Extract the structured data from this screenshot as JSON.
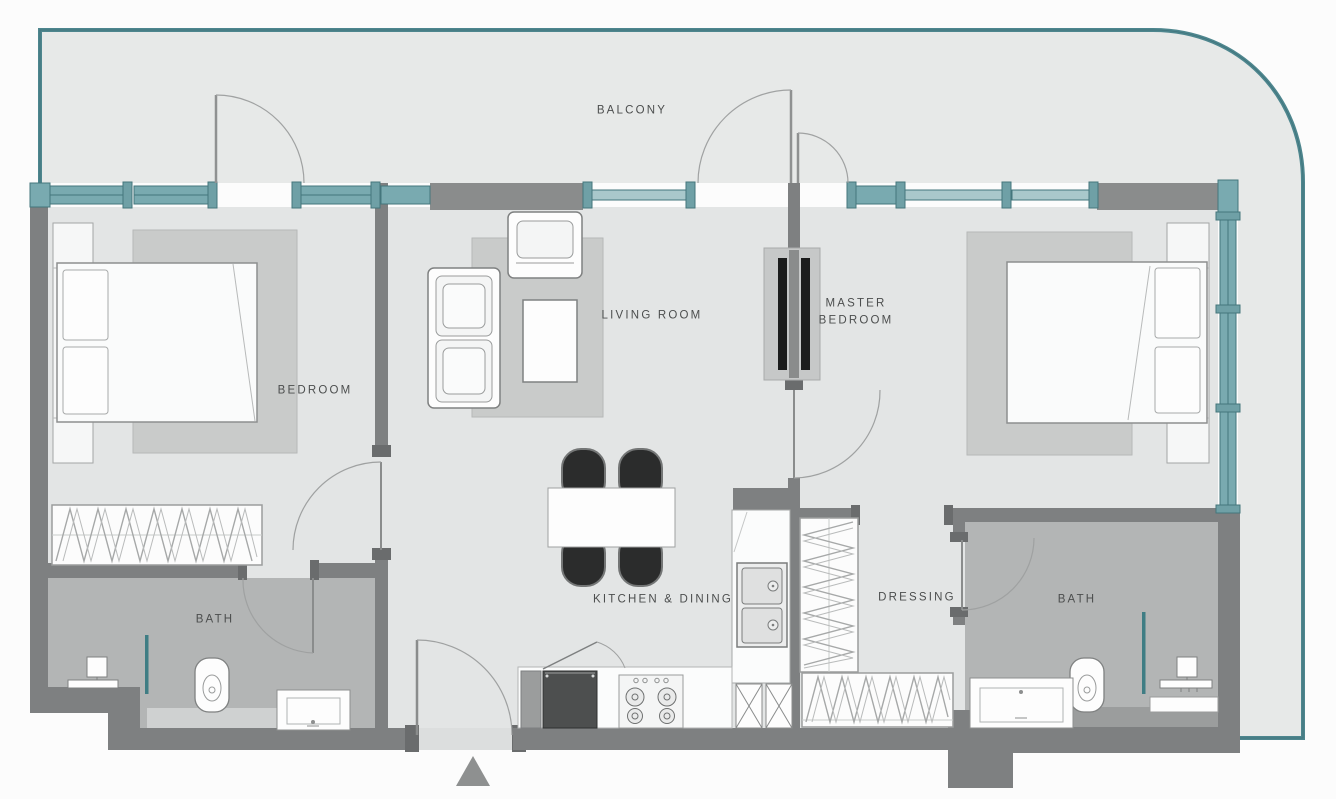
{
  "plan": {
    "type": "apartment-floor-plan",
    "rooms": [
      {
        "id": "balcony",
        "label": "BALCONY"
      },
      {
        "id": "bedroom",
        "label": "BEDROOM"
      },
      {
        "id": "living-room",
        "label": "LIVING ROOM"
      },
      {
        "id": "master-bedroom",
        "label": "MASTER BEDROOM"
      },
      {
        "id": "bath-1",
        "label": "BATH"
      },
      {
        "id": "kitchen-dining",
        "label": "KITCHEN & DINING"
      },
      {
        "id": "dressing",
        "label": "DRESSING"
      },
      {
        "id": "bath-2",
        "label": "BATH"
      }
    ],
    "icons": [
      {
        "name": "entrance-arrow",
        "shape": "triangle-up"
      }
    ],
    "colors": {
      "glazing_teal": "#79aab0",
      "glazing_edge": "#44767c",
      "outer_rail_teal": "#4e868e",
      "wall_grey": "#7e8081",
      "wall_dark": "#6a6c6d",
      "wall_block": "#8a8c8c",
      "floor_light": "#e3e5e5",
      "balcony_floor": "#e7e9e8",
      "bath_floor": "#b3b5b5",
      "rug_grey": "#c9cbca",
      "chair_black": "#2b2c2c",
      "fridge_dark": "#4d4f4f",
      "background": "#fcfcfc"
    }
  }
}
